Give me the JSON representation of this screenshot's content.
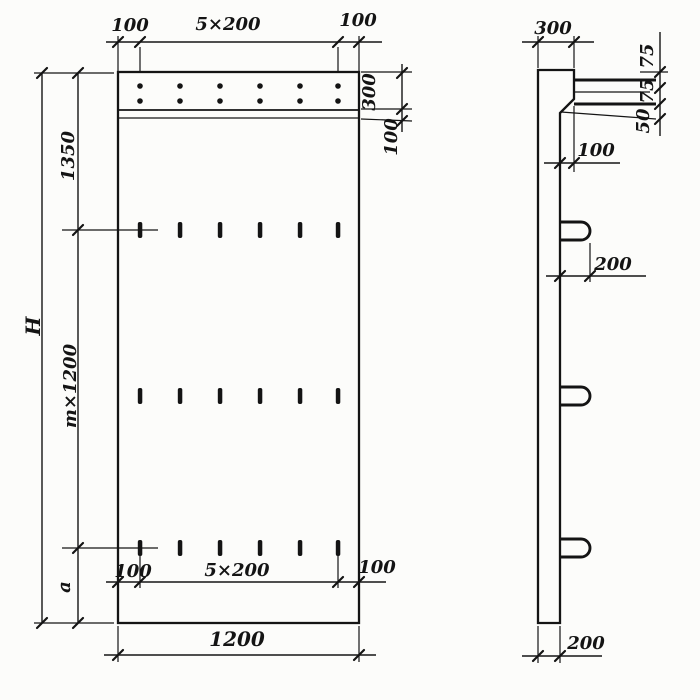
{
  "front": {
    "top": {
      "left": "100",
      "center": "5×200",
      "right": "100"
    },
    "right": {
      "band": "300",
      "strip": "100"
    },
    "left": {
      "upper": "1350",
      "middle": "m×1200",
      "lower": "a",
      "total": "H"
    },
    "bottom_inner": {
      "left": "100",
      "center": "5×200",
      "right": "100"
    },
    "bottom_total": "1200"
  },
  "side": {
    "top": "300",
    "right": {
      "seg1": "75",
      "seg2": "75",
      "seg3": "50"
    },
    "step": "100",
    "loop": "200",
    "thickness": "200"
  },
  "colors": {
    "ink": "#141414",
    "paper": "#fcfcfa"
  }
}
